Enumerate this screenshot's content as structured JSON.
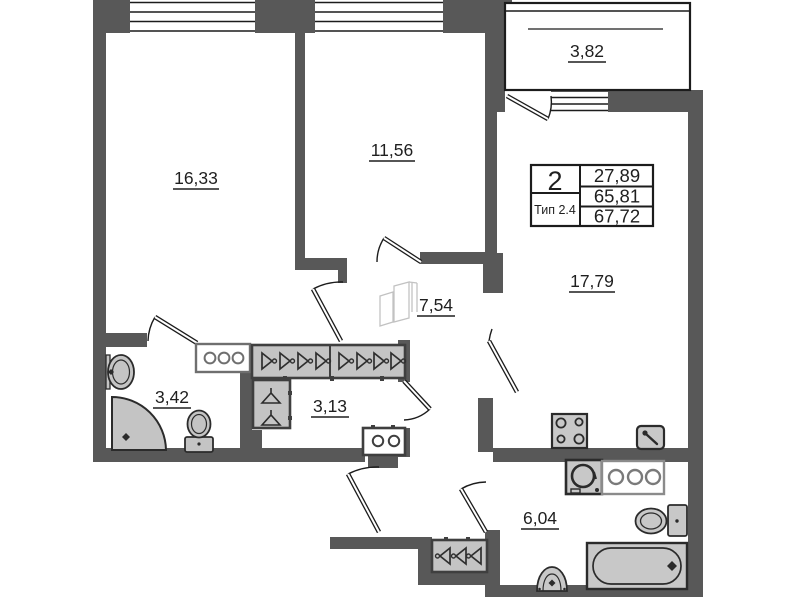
{
  "plan": {
    "background": "#ffffff",
    "wall_color": "#585858",
    "rooms": [
      {
        "name": "room-1",
        "area": "16,33"
      },
      {
        "name": "room-2",
        "area": "11,56"
      },
      {
        "name": "balcony",
        "area": "3,82"
      },
      {
        "name": "hallway",
        "area": "7,54"
      },
      {
        "name": "kitchen-living-room",
        "area": "17,79"
      },
      {
        "name": "bathroom",
        "area": "3,42"
      },
      {
        "name": "wardrobe-room",
        "area": "3,13"
      },
      {
        "name": "bathroom-2",
        "area": "6,04"
      }
    ],
    "info_box": {
      "rooms_count": "2",
      "type": "Тип 2.4",
      "living_area": "27,89",
      "area_without_balcony": "65,81",
      "total_area": "67,72"
    },
    "fixtures": [
      "corner-shower",
      "washbasin",
      "toilet",
      "sliding-wardrobe",
      "hanger-wardrobe",
      "shoe-cabinet",
      "washing-machine",
      "stove",
      "kitchen-sink",
      "counter",
      "toilet-2",
      "bathtub",
      "pedestal-sink",
      "hall-wardrobe"
    ]
  }
}
